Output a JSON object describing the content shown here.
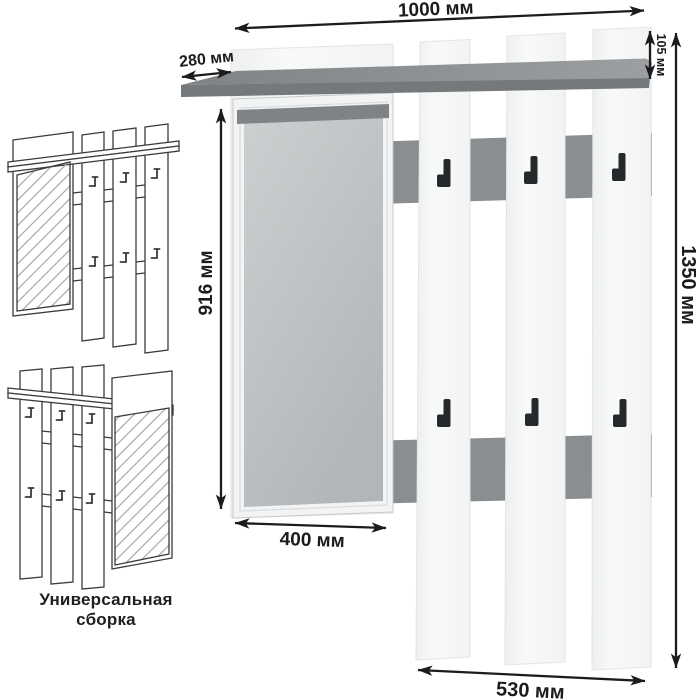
{
  "product": {
    "type_hint": "wall coat rack with mirror, shelf and hooks",
    "hooks": {
      "upper_count": 3,
      "lower_count": 3
    }
  },
  "dimensions": {
    "top_width": "1000 мм",
    "shelf_depth": "280 мм",
    "shelf_height": "105 мм",
    "mirror_height": "916 мм",
    "total_height": "1350 мм",
    "mirror_width": "400 мм",
    "bottom_width": "530 мм"
  },
  "caption": "Универсальная сборка",
  "colors": {
    "dimension": "#1c1c1c",
    "shelf_top": "#8d9194",
    "shelf_edge": "#75797c",
    "strip": "#8a8e91",
    "slat": "#f5f6f6",
    "slat_edge": "#e2e4e5",
    "mirror_frame": "#f2f3f4",
    "mirror_frame_edge": "#c7cacc",
    "mirror_bevel": "#d9dbdc",
    "mirror_glass": "#c2c5c7",
    "mirror_shadow": "#7f8386",
    "hook": "#26292b",
    "sketch_line": "#3b3b3b",
    "hatch": "#9ba1a4",
    "caption_color": "#1f1f1f"
  }
}
